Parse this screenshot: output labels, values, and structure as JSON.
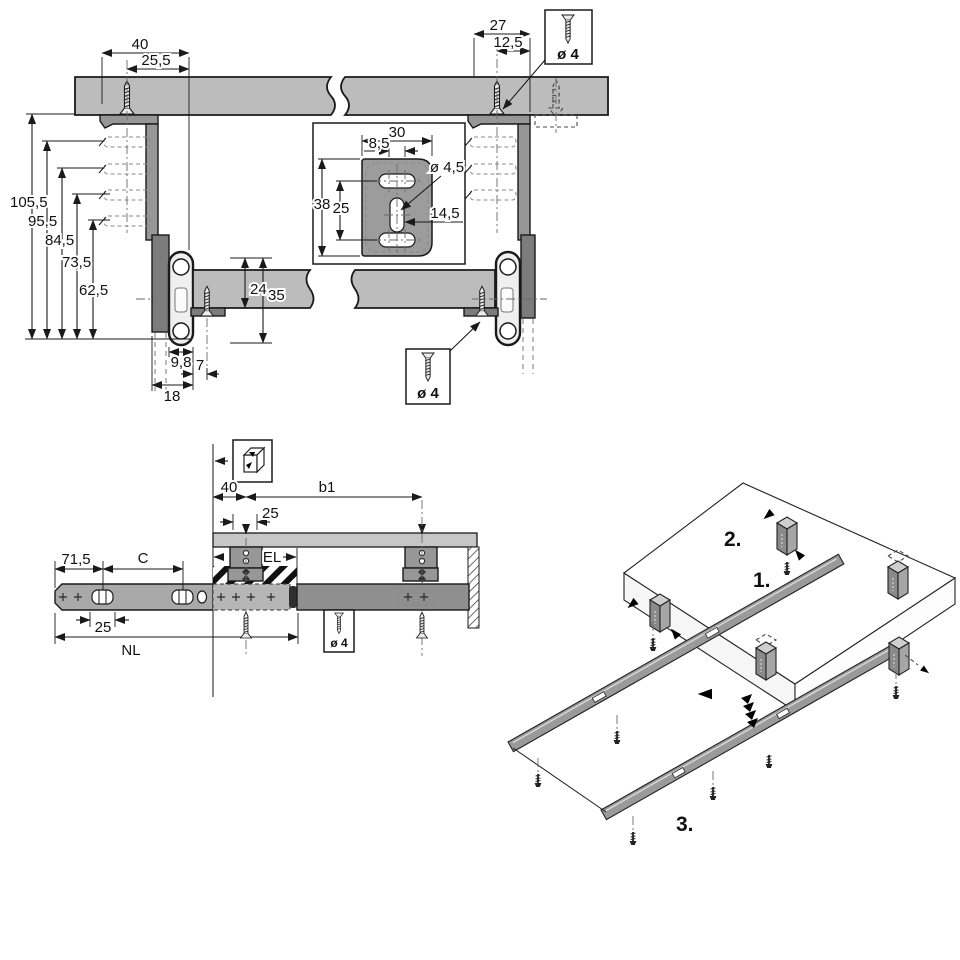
{
  "palette": {
    "panel_gray": "#bcbcbc",
    "bracket_gray": "#979797",
    "bracket_dark": "#7c7c7c",
    "rail_light": "#efefef",
    "side_rail": "#a9a9a9",
    "line": "#1a1a1a"
  },
  "top_view": {
    "dims": {
      "bracket_offset": "40",
      "screw_offset": "25,5",
      "right_bracket_offset": "27",
      "right_screw_offset": "12,5",
      "heights": [
        "105,5",
        "95,5",
        "84,5",
        "73,5",
        "62,5"
      ],
      "shelf_drop": "24",
      "rail_height": "35",
      "rail_width": "9,8",
      "screw_inset": "7",
      "bracket_depth": "18"
    },
    "detail": {
      "plate_width": "30",
      "hole_spacing": "8,5",
      "hole_dia": "ø 4,5",
      "plate_height": "38",
      "hole_pitch": "25",
      "slot_length": "14,5"
    },
    "screw_box_top": {
      "label": "ø 4"
    },
    "screw_box_bottom": {
      "label": "ø 4"
    }
  },
  "side_view": {
    "dims": {
      "front_offset": "40",
      "bracket_span": "b1",
      "bracket_width": "25",
      "extension": "EL",
      "front_length": "71,5",
      "hole_distance": "C",
      "slot_pitch": "25",
      "nominal_length": "NL"
    },
    "screw_box": {
      "label": "ø 4"
    }
  },
  "assembly": {
    "step_1": "1.",
    "step_2": "2.",
    "step_3": "3."
  },
  "icons": [
    "screw-icon",
    "cube-orientation-icon",
    "dimension-arrow",
    "insertion-arrow",
    "spring-impact-arrows"
  ]
}
